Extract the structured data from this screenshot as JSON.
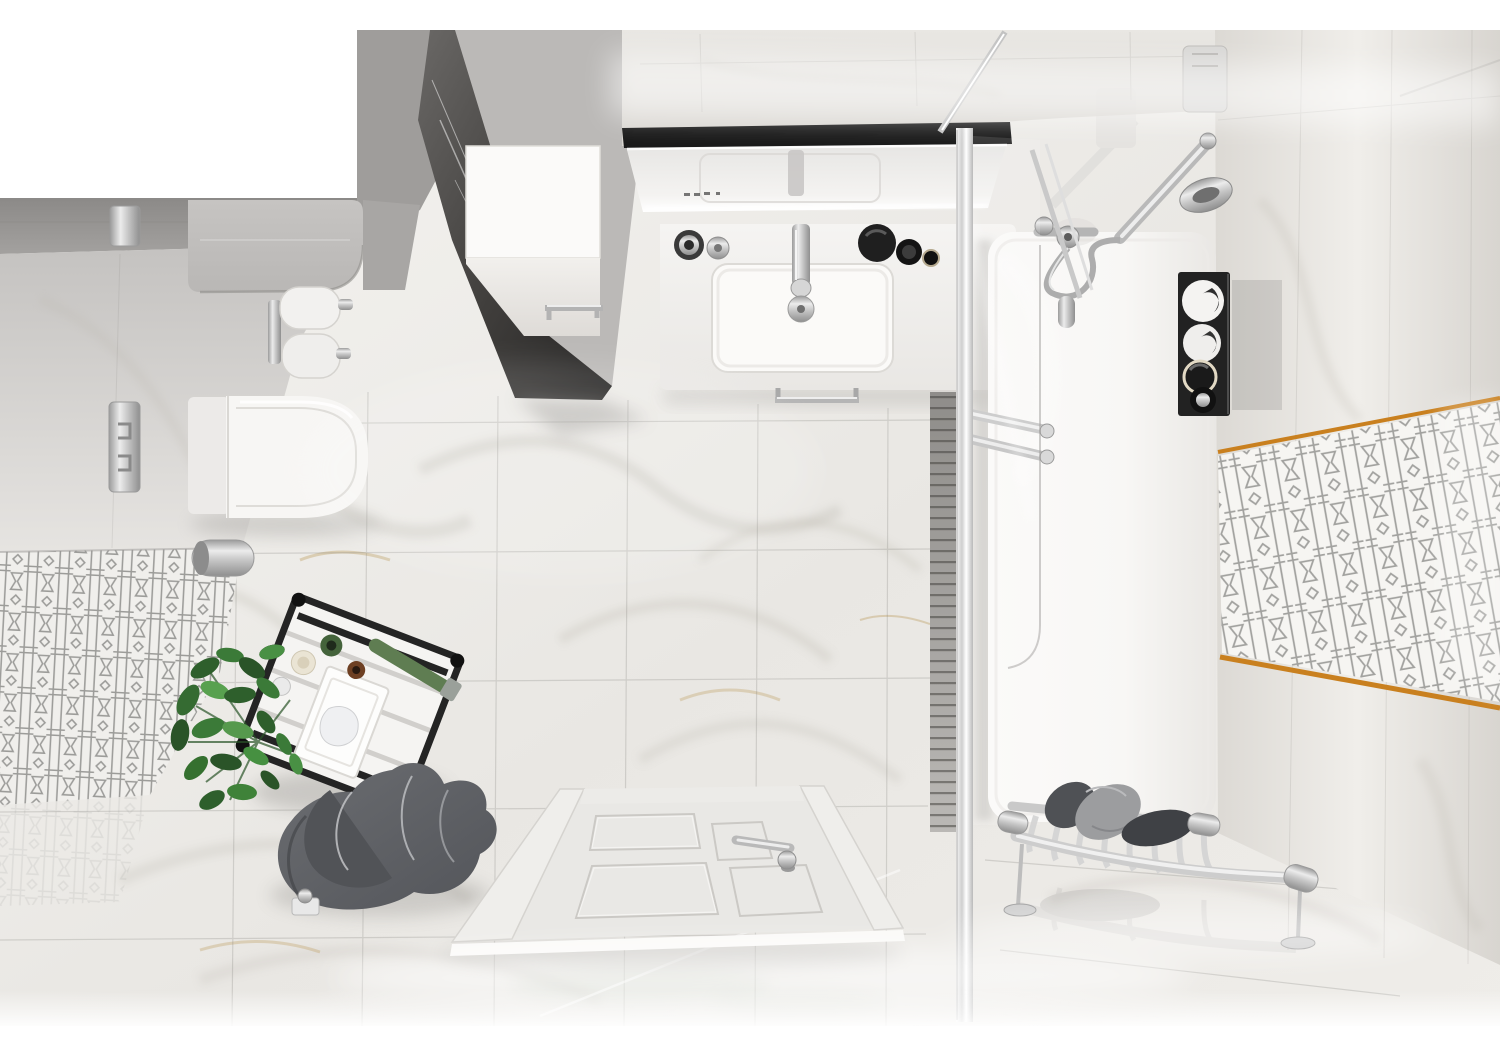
{
  "meta": {
    "scene": "top-down 3d render of a marble bathroom",
    "view": "bird's-eye",
    "canvas": {
      "width": 1500,
      "height": 1061
    }
  },
  "palette": {
    "bg": "#ffffff",
    "floorLight": "#f5f4f1",
    "floorMid": "#e9e7e3",
    "floorWarm": "#efede9",
    "veinGrey": "#b7b2a8",
    "veinGold": "#b8954f",
    "wallTopA": "#e9e7e3",
    "wallTopB": "#d8d5d0",
    "wallRightA": "#f0eeea",
    "wallRightB": "#dcd9d4",
    "wallGrey": "#a3a19f",
    "wallGreyDark": "#8b8987",
    "ledgeGrey": "#b9b7b5",
    "darkMarbleA": "#6a6866",
    "darkMarbleB": "#232221",
    "porcelain": "#f7f6f4",
    "tubWhite": "#f8f7f5",
    "chrome": "#bcbcbc",
    "chromeDark": "#8f8f8f",
    "chromeLight": "#ececec",
    "mirrorBlack": "#191919",
    "glassTint": "#eef0f1",
    "towelDark": "#53555a",
    "towelMid": "#6b6d71",
    "towelLight": "#9c9d9f",
    "plantGreen": "#3b7a38",
    "plantDark": "#2a5428",
    "plantLight": "#58a14f",
    "accentOrange": "#c9801f",
    "latticeGrey": "#8d8d8b",
    "crateBlack": "#222222",
    "doorWhite": "#e9e8e5",
    "shadowGrey": "#8e8c88"
  },
  "objects": [
    {
      "name": "marble-floor",
      "label": "polished white marble tile floor"
    },
    {
      "name": "left-wall-lattice-band",
      "label": "grey geometric lattice tile band, left wall"
    },
    {
      "name": "right-wall-lattice-band",
      "label": "grey geometric lattice tile band, right wall"
    },
    {
      "name": "lattice-trim-top",
      "label": "orange listello trim line (top)"
    },
    {
      "name": "lattice-trim-bottom",
      "label": "orange listello trim line (bottom)"
    },
    {
      "name": "dark-partition-wall",
      "label": "dark marble partition wall"
    },
    {
      "name": "cistern-ledge",
      "label": "grey marble ledge above toilet"
    },
    {
      "name": "toilet",
      "label": "wall-hung white toilet"
    },
    {
      "name": "flush-plate",
      "label": "chrome flush plate"
    },
    {
      "name": "switch-plate",
      "label": "chrome wall plate"
    },
    {
      "name": "toilet-paper-holder",
      "label": "double toilet paper holder with two rolls"
    },
    {
      "name": "brush-holder",
      "label": "chrome toilet brush holder"
    },
    {
      "name": "wall-cabinet",
      "label": "white wall cabinet with chrome handle"
    },
    {
      "name": "mirror",
      "label": "LED mirror with black frame"
    },
    {
      "name": "vanity-counter",
      "label": "white vanity washbasin"
    },
    {
      "name": "faucet",
      "label": "chrome basin mixer"
    },
    {
      "name": "basin-drain",
      "label": "chrome drain"
    },
    {
      "name": "cosmetics",
      "label": "cosmetic bottles and jars on counter"
    },
    {
      "name": "vanity-towel-rail",
      "label": "chrome towel rail on vanity"
    },
    {
      "name": "shower-glass",
      "label": "glass shower screen with chrome profile"
    },
    {
      "name": "slatted-panel",
      "label": "grey slatted panel beside shower"
    },
    {
      "name": "shower-set",
      "label": "chrome shower arm, hand shower and hose"
    },
    {
      "name": "bathtub",
      "label": "white bathtub / shower tray"
    },
    {
      "name": "tub-towel-bars",
      "label": "double chrome towel bars"
    },
    {
      "name": "accessory-shelf",
      "label": "black shelf with rolled towels and jars"
    },
    {
      "name": "storage-crate",
      "label": "black-frame crate with tissue box and toiletries"
    },
    {
      "name": "plant",
      "label": "green potted plant"
    },
    {
      "name": "floor-towels",
      "label": "dark grey towels on hook"
    },
    {
      "name": "robe-hook",
      "label": "chrome floor-level hook"
    },
    {
      "name": "door",
      "label": "white panelled door with chrome handle"
    },
    {
      "name": "towel-rack",
      "label": "chrome towel rack with grey towels"
    }
  ]
}
